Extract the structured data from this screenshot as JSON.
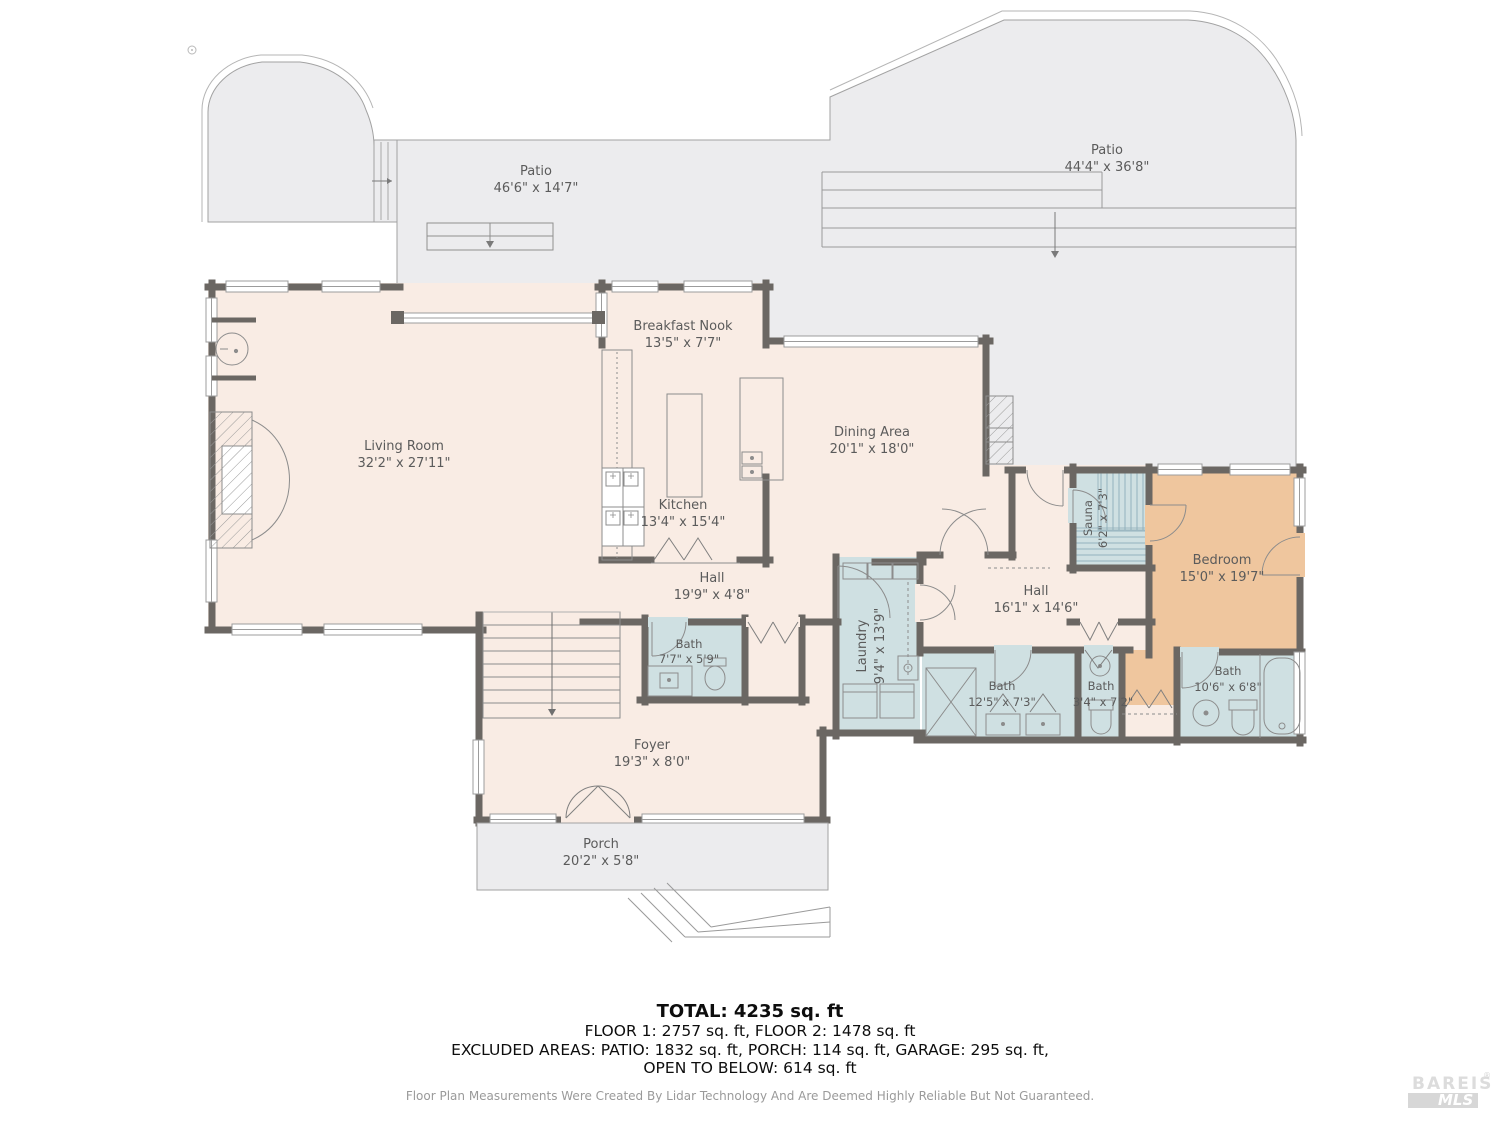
{
  "rooms": {
    "patio_left": {
      "name": "Patio",
      "dims": "46'6\" x 14'7\""
    },
    "patio_right": {
      "name": "Patio",
      "dims": "44'4\" x 36'8\""
    },
    "living_room": {
      "name": "Living Room",
      "dims": "32'2\" x 27'11\""
    },
    "breakfast_nook": {
      "name": "Breakfast Nook",
      "dims": "13'5\" x 7'7\""
    },
    "kitchen": {
      "name": "Kitchen",
      "dims": "13'4\" x 15'4\""
    },
    "dining_area": {
      "name": "Dining Area",
      "dims": "20'1\" x 18'0\""
    },
    "hall_small": {
      "name": "Hall",
      "dims": "19'9\" x 4'8\""
    },
    "bath_main": {
      "name": "Bath",
      "dims": "7'7\" x 5'9\""
    },
    "laundry": {
      "name": "Laundry",
      "dims": "9'4\" x 13'9\""
    },
    "hall_large": {
      "name": "Hall",
      "dims": "16'1\" x 14'6\""
    },
    "sauna": {
      "name": "Sauna",
      "dims": "6'2\" x 7'3\""
    },
    "bedroom": {
      "name": "Bedroom",
      "dims": "15'0\" x 19'7\""
    },
    "bath_shared": {
      "name": "Bath",
      "dims": "12'5\" x 7'3\""
    },
    "bath_powder": {
      "name": "Bath",
      "dims": "3'4\" x 7'2\""
    },
    "bath_ensuite": {
      "name": "Bath",
      "dims": "10'6\" x 6'8\""
    },
    "foyer": {
      "name": "Foyer",
      "dims": "19'3\" x 8'0\""
    },
    "porch": {
      "name": "Porch",
      "dims": "20'2\" x 5'8\""
    }
  },
  "summary": {
    "total": "TOTAL: 4235 sq. ft",
    "floors": "FLOOR 1: 2757 sq. ft, FLOOR 2: 1478 sq. ft",
    "excluded": "EXCLUDED AREAS: PATIO: 1832 sq. ft, PORCH: 114 sq. ft, GARAGE: 295 sq. ft,",
    "open_below": "OPEN TO BELOW: 614 sq. ft"
  },
  "disclaimer": "Floor Plan Measurements Were Created By Lidar Technology And Are Deemed Highly Reliable But Not Guaranteed.",
  "logo": {
    "brand": "BAREIS",
    "reg": "®",
    "sub": "MLS"
  },
  "colors": {
    "wall": "#6b6763",
    "floor": "#f9ece4",
    "patio": "#ececee",
    "wet_room": "#cfe0e2",
    "bedroom": "#efc69e",
    "label_text": "#5b5b5b"
  }
}
